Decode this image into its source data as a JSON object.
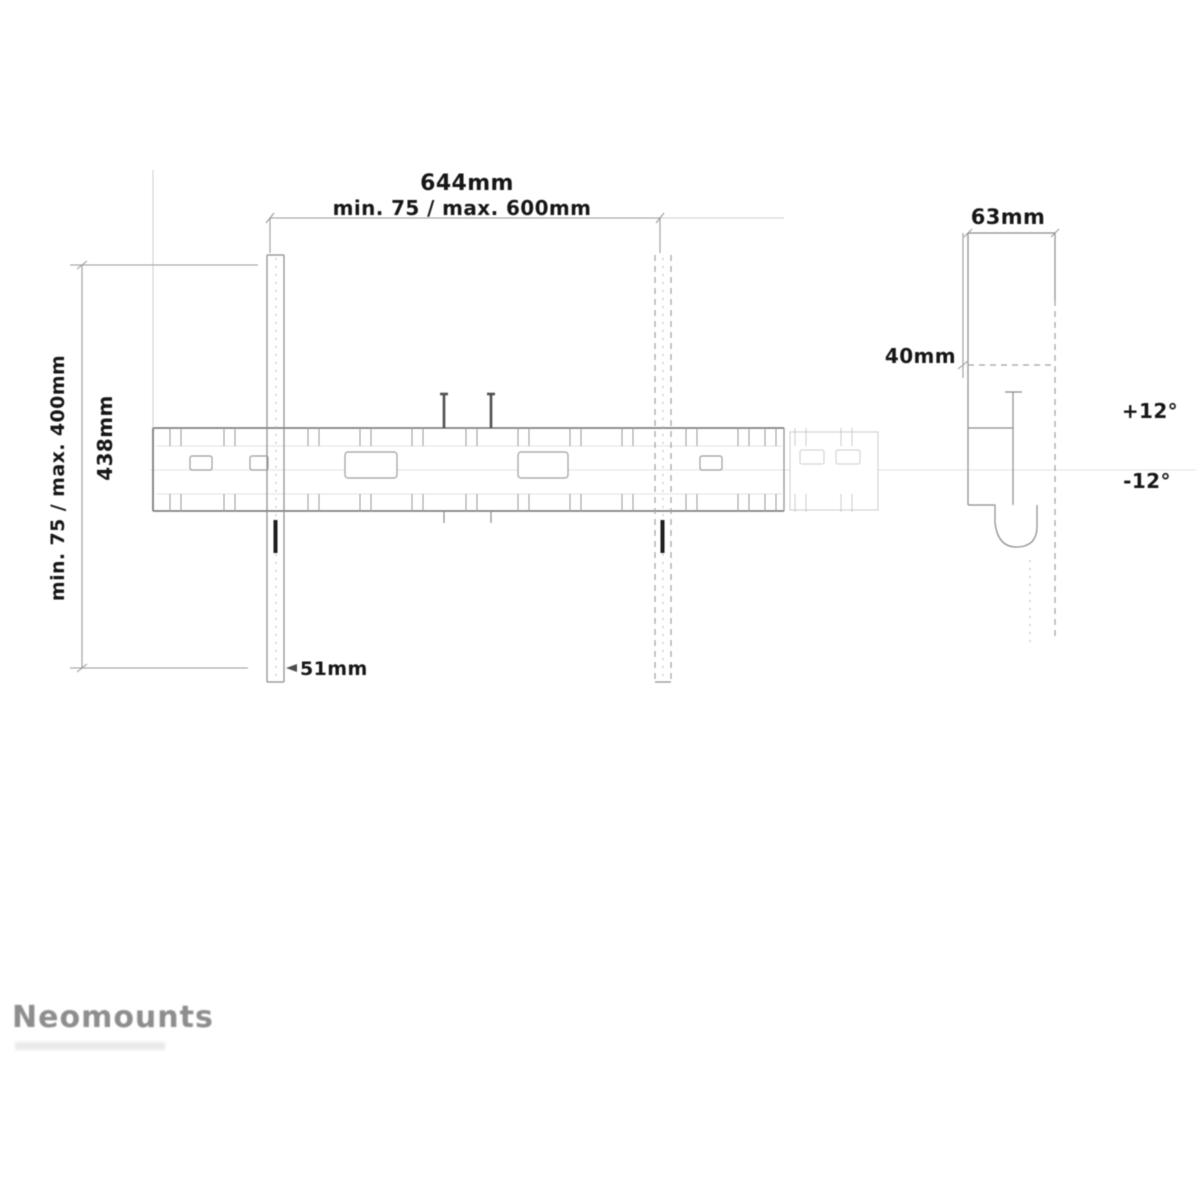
{
  "drawing": {
    "front": {
      "width_total": "644mm",
      "vesa_horizontal": "min. 75 / max. 600mm",
      "vesa_vertical": "min. 75 / max. 400mm",
      "height_total": "438mm",
      "rail_width": "51mm"
    },
    "side": {
      "depth": "63mm",
      "offset": "40mm",
      "tilt_up": "+12°",
      "tilt_down": "-12°"
    },
    "brand": "Neomounts"
  }
}
